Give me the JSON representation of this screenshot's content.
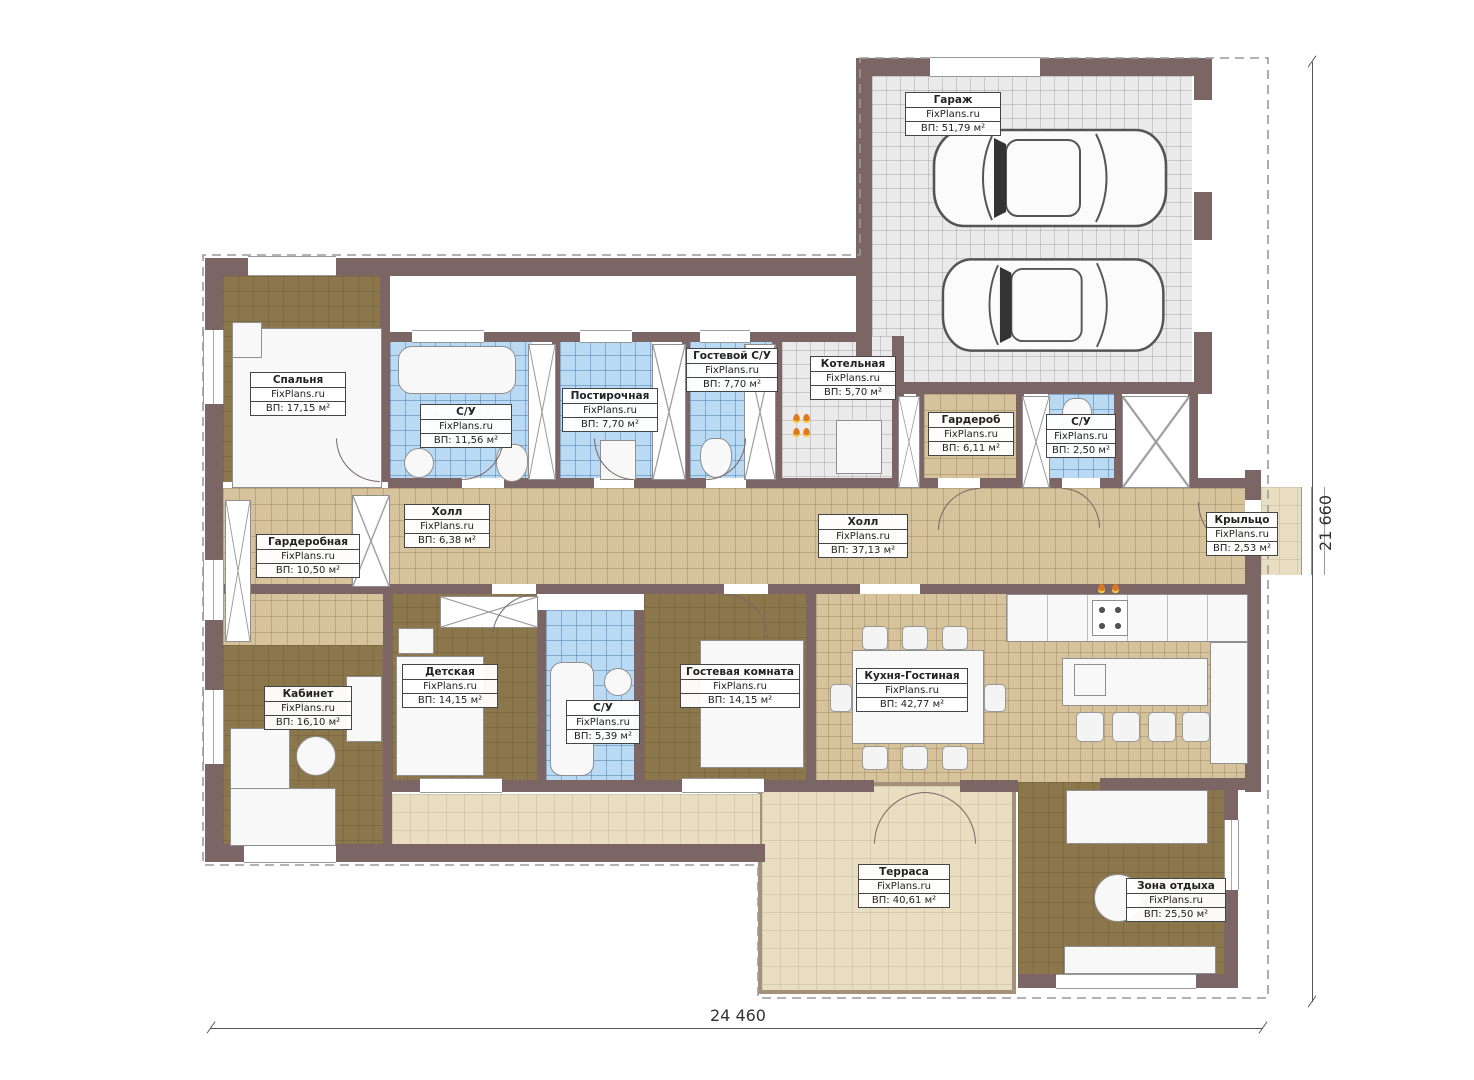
{
  "plan": {
    "title": "Планировка одноэтажного дома",
    "watermark": "FixPlans.ru",
    "dimensions": {
      "width_label": "24 460",
      "height_label": "21 660"
    },
    "colors": {
      "wall": "#7b6565",
      "floor_tan": "#d6c39c",
      "floor_blue": "#badaf3",
      "floor_gray": "#eaeaea",
      "floor_brown": "#8c764b",
      "floor_beige": "#e9ddc2",
      "flame_accent": "#e07820"
    },
    "rooms": [
      {
        "name": "Гараж",
        "area": "ВП: 51,79 м²"
      },
      {
        "name": "Спальня",
        "area": "ВП: 17,15 м²"
      },
      {
        "name": "С/У",
        "area": "ВП: 11,56 м²"
      },
      {
        "name": "Постирочная",
        "area": "ВП: 7,70 м²"
      },
      {
        "name": "Гостевой С/У",
        "area": "ВП: 7,70 м²"
      },
      {
        "name": "Котельная",
        "area": "ВП: 5,70 м²"
      },
      {
        "name": "Гардероб",
        "area": "ВП: 6,11 м²"
      },
      {
        "name": "С/У",
        "area": "ВП: 2,50 м²"
      },
      {
        "name": "Холл",
        "area": "ВП: 6,38 м²"
      },
      {
        "name": "Холл",
        "area": "ВП: 37,13 м²"
      },
      {
        "name": "Крыльцо",
        "area": "ВП: 2,53 м²"
      },
      {
        "name": "Гардеробная",
        "area": "ВП: 10,50 м²"
      },
      {
        "name": "Кабинет",
        "area": "ВП: 16,10 м²"
      },
      {
        "name": "Детская",
        "area": "ВП: 14,15 м²"
      },
      {
        "name": "С/У",
        "area": "ВП: 5,39 м²"
      },
      {
        "name": "Гостевая комната",
        "area": "ВП: 14,15 м²"
      },
      {
        "name": "Кухня-Гостиная",
        "area": "ВП: 42,77 м²"
      },
      {
        "name": "Терраса",
        "area": "ВП: 40,61 м²"
      },
      {
        "name": "Зона отдыха",
        "area": "ВП: 25,50 м²"
      }
    ]
  }
}
